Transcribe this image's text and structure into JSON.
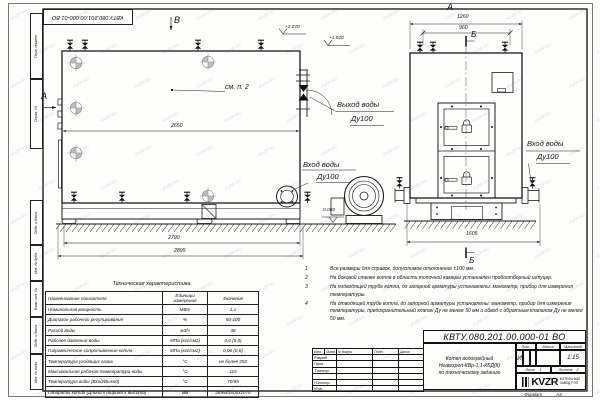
{
  "watermark": "KVZR.RU",
  "stamp_top": "КВТУ.080.201.00.000-01 ВО",
  "margin_labels": [
    "Перв. примен.",
    "Справ. №",
    "Подп. и дата",
    "Инв. № дубл.",
    "Взам. инв. №",
    "Подп. и дата",
    "Инв. № подл."
  ],
  "labels": {
    "view_b": "В",
    "view_a_side": "А",
    "view_a_top": "А",
    "sec_b_top": "Б",
    "sec_b_bottom": "Б",
    "see_note": "см. п. 2",
    "elev_2070": "+2,070",
    "elev_1920": "+1,920",
    "elev_0": "0.000",
    "out_water": "Выход воды",
    "out_dn": "Ду100",
    "in_water_left": "Вход воды",
    "in_dn_left": "Ду100",
    "in_water_right": "Вход воды",
    "in_dn_right": "Ду100",
    "d2650": "2650",
    "d2790": "2790",
    "d2895": "2895",
    "d1260": "1260",
    "d960": "960",
    "d1605": "1605"
  },
  "notes": {
    "items": [
      {
        "num": "1",
        "text": "Все размеры для справок, допустимое отклонение ±100 мм."
      },
      {
        "num": "2",
        "text": "На боковой стенке котла в области топочной камеры установлен пробоотборный штуцер."
      },
      {
        "num": "3",
        "text": "На подводящей трубе котла, до запорной арматуры установлены: манометр, прибор для измерения температуры."
      },
      {
        "num": "4",
        "text": "На отводящей трубе котла, до запорной арматуры установлены: манометр, прибор для измерения температуры, предохранительный клапан Ду не менее 50 мм и обвод с обратным клапаном Ду не менее 50 мм."
      }
    ]
  },
  "spec_table": {
    "title": "Техническая характеристика",
    "headers": [
      "Наименование показателя",
      "Единицы измерения",
      "Значение"
    ],
    "rows": [
      [
        "Номинальная мощность",
        "МВт",
        "1,1"
      ],
      [
        "Диапазон рабочего регулирования",
        "%",
        "50-100"
      ],
      [
        "Расход воды",
        "м3/ч",
        "38"
      ],
      [
        "Рабочее давление воды",
        "МПа (кгс/см2)",
        "0,6 (6,0)"
      ],
      [
        "Гидравлическое сопротивление котла",
        "МПа (кгс/см2)",
        "0,06 (0,6)"
      ],
      [
        "Температура уходящих газов",
        "°С",
        "не более 250"
      ],
      [
        "Максимальная рабочая температура воды",
        "°С",
        "115"
      ],
      [
        "Температура воды (Вход/Выход)",
        "°С",
        "70/95"
      ],
      [
        "Габариты котла (Длина х ширина х высота)",
        "мм",
        "2895х1605х2070"
      ]
    ]
  },
  "title_block": {
    "doc_number": "КВТУ.080.201.00.000-01  ВО",
    "name_line1": "Котел водогрейный",
    "name_line2": "Heatexpert-КВр-1,1-КБД(К)",
    "name_line3": "по техническому заданию",
    "col_izm": "Изм.",
    "col_list": "Лист",
    "col_doc": "N докум.",
    "col_podp": "Подп.",
    "col_data": "Дата",
    "row_razrab": "Разраб.",
    "row_prov": "Пров.",
    "row_tkontr": "Т.контр.",
    "row_nkontr": "Н.контр.",
    "row_utv": "Утв.",
    "lit_label": "Лит.",
    "lit_value": "И",
    "mass_label": "Масса",
    "scale_label": "Масштаб",
    "scale_value": "1:15",
    "sheet_label": "Лист",
    "sheet_value": "1",
    "sheets_label": "Листов",
    "sheets_value": "2",
    "logo_text": "KVZR",
    "company_line1": "КОТЕЛЬНЫЙ",
    "company_line2": "ЗАВОД РЭП",
    "format_label": "Формат",
    "format_value": "А3"
  }
}
